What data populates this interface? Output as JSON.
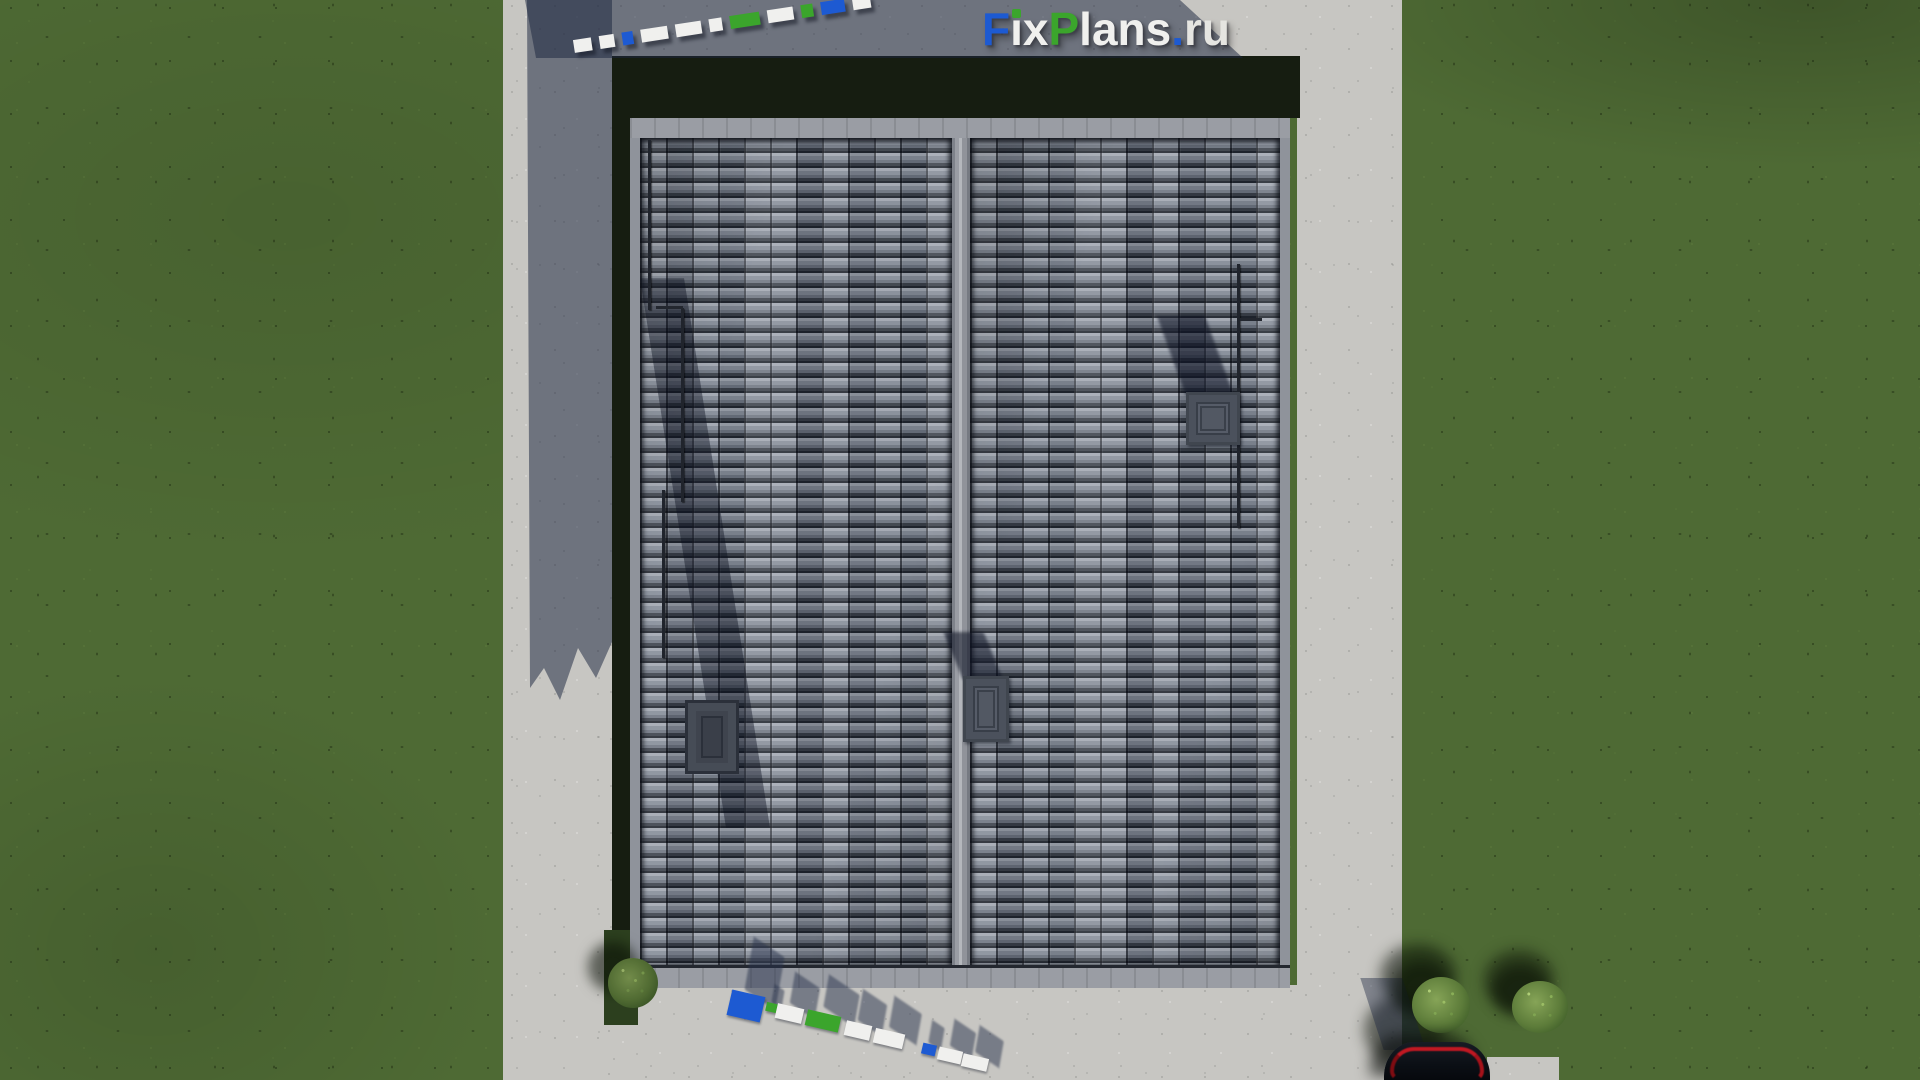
{
  "brand": {
    "name": "FixPlans.ru",
    "segments": [
      {
        "ch": "F",
        "color": "blue"
      },
      {
        "ch": "ı",
        "color": "white",
        "dot": "green"
      },
      {
        "ch": "x",
        "color": "white"
      },
      {
        "ch": "P",
        "color": "green"
      },
      {
        "ch": "lans",
        "color": "white"
      },
      {
        "ch": ".",
        "color": "blue"
      },
      {
        "ch": "ru",
        "color": "white2"
      }
    ]
  },
  "palette": {
    "blue": "#1d5ad2",
    "green": "#3ba52c",
    "white": "#f0f0ee",
    "white2": "#e5e5e1",
    "grass": "#4e6a34",
    "grass_shadow": "#161d11",
    "concrete": "#c7c6c2",
    "concrete_shadow": "rgba(28,38,64,0.52)",
    "roof_tile_base": "#717886",
    "roof_trim": "#9a9da4",
    "chimney": "#565c68",
    "car_body": "#0b0f15",
    "car_taillight": "#c01822",
    "bush": "#5d7c3a"
  },
  "watermark_strip_top": {
    "block_colors": [
      "white",
      "white",
      "blue",
      "white",
      "white",
      "white",
      "green",
      "white",
      "green",
      "blue",
      "white"
    ]
  },
  "watermark_strip_bottom": {
    "block_colors": [
      "blue",
      "green",
      "white",
      "green",
      "white",
      "white",
      "blue",
      "white",
      "white"
    ]
  }
}
